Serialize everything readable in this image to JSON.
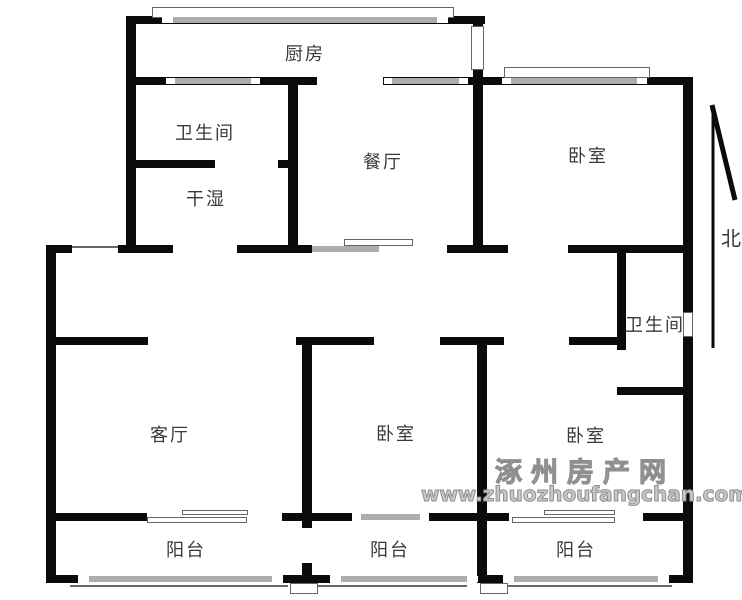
{
  "rooms": {
    "kitchen": "厨房",
    "bathroom_top": "卫生间",
    "dry_wet": "干湿",
    "dining": "餐厅",
    "bedroom_ne": "卧室",
    "bathroom_mid": "卫生间",
    "living": "客厅",
    "bedroom_s": "卧室",
    "bedroom_se": "卧室",
    "balcony_w": "阳台",
    "balcony_m": "阳台",
    "balcony_e": "阳台"
  },
  "compass": {
    "north": "北"
  },
  "watermark": {
    "site_name": "涿州房产网",
    "site_url": "www.zhuozhoufangchan.com"
  },
  "colors": {
    "wall": "#0b0b0b",
    "window_fill": "#adadad",
    "thin_line": "#666666",
    "label_text": "#3a3a3a",
    "watermark_gray": "#a6a6a6"
  }
}
